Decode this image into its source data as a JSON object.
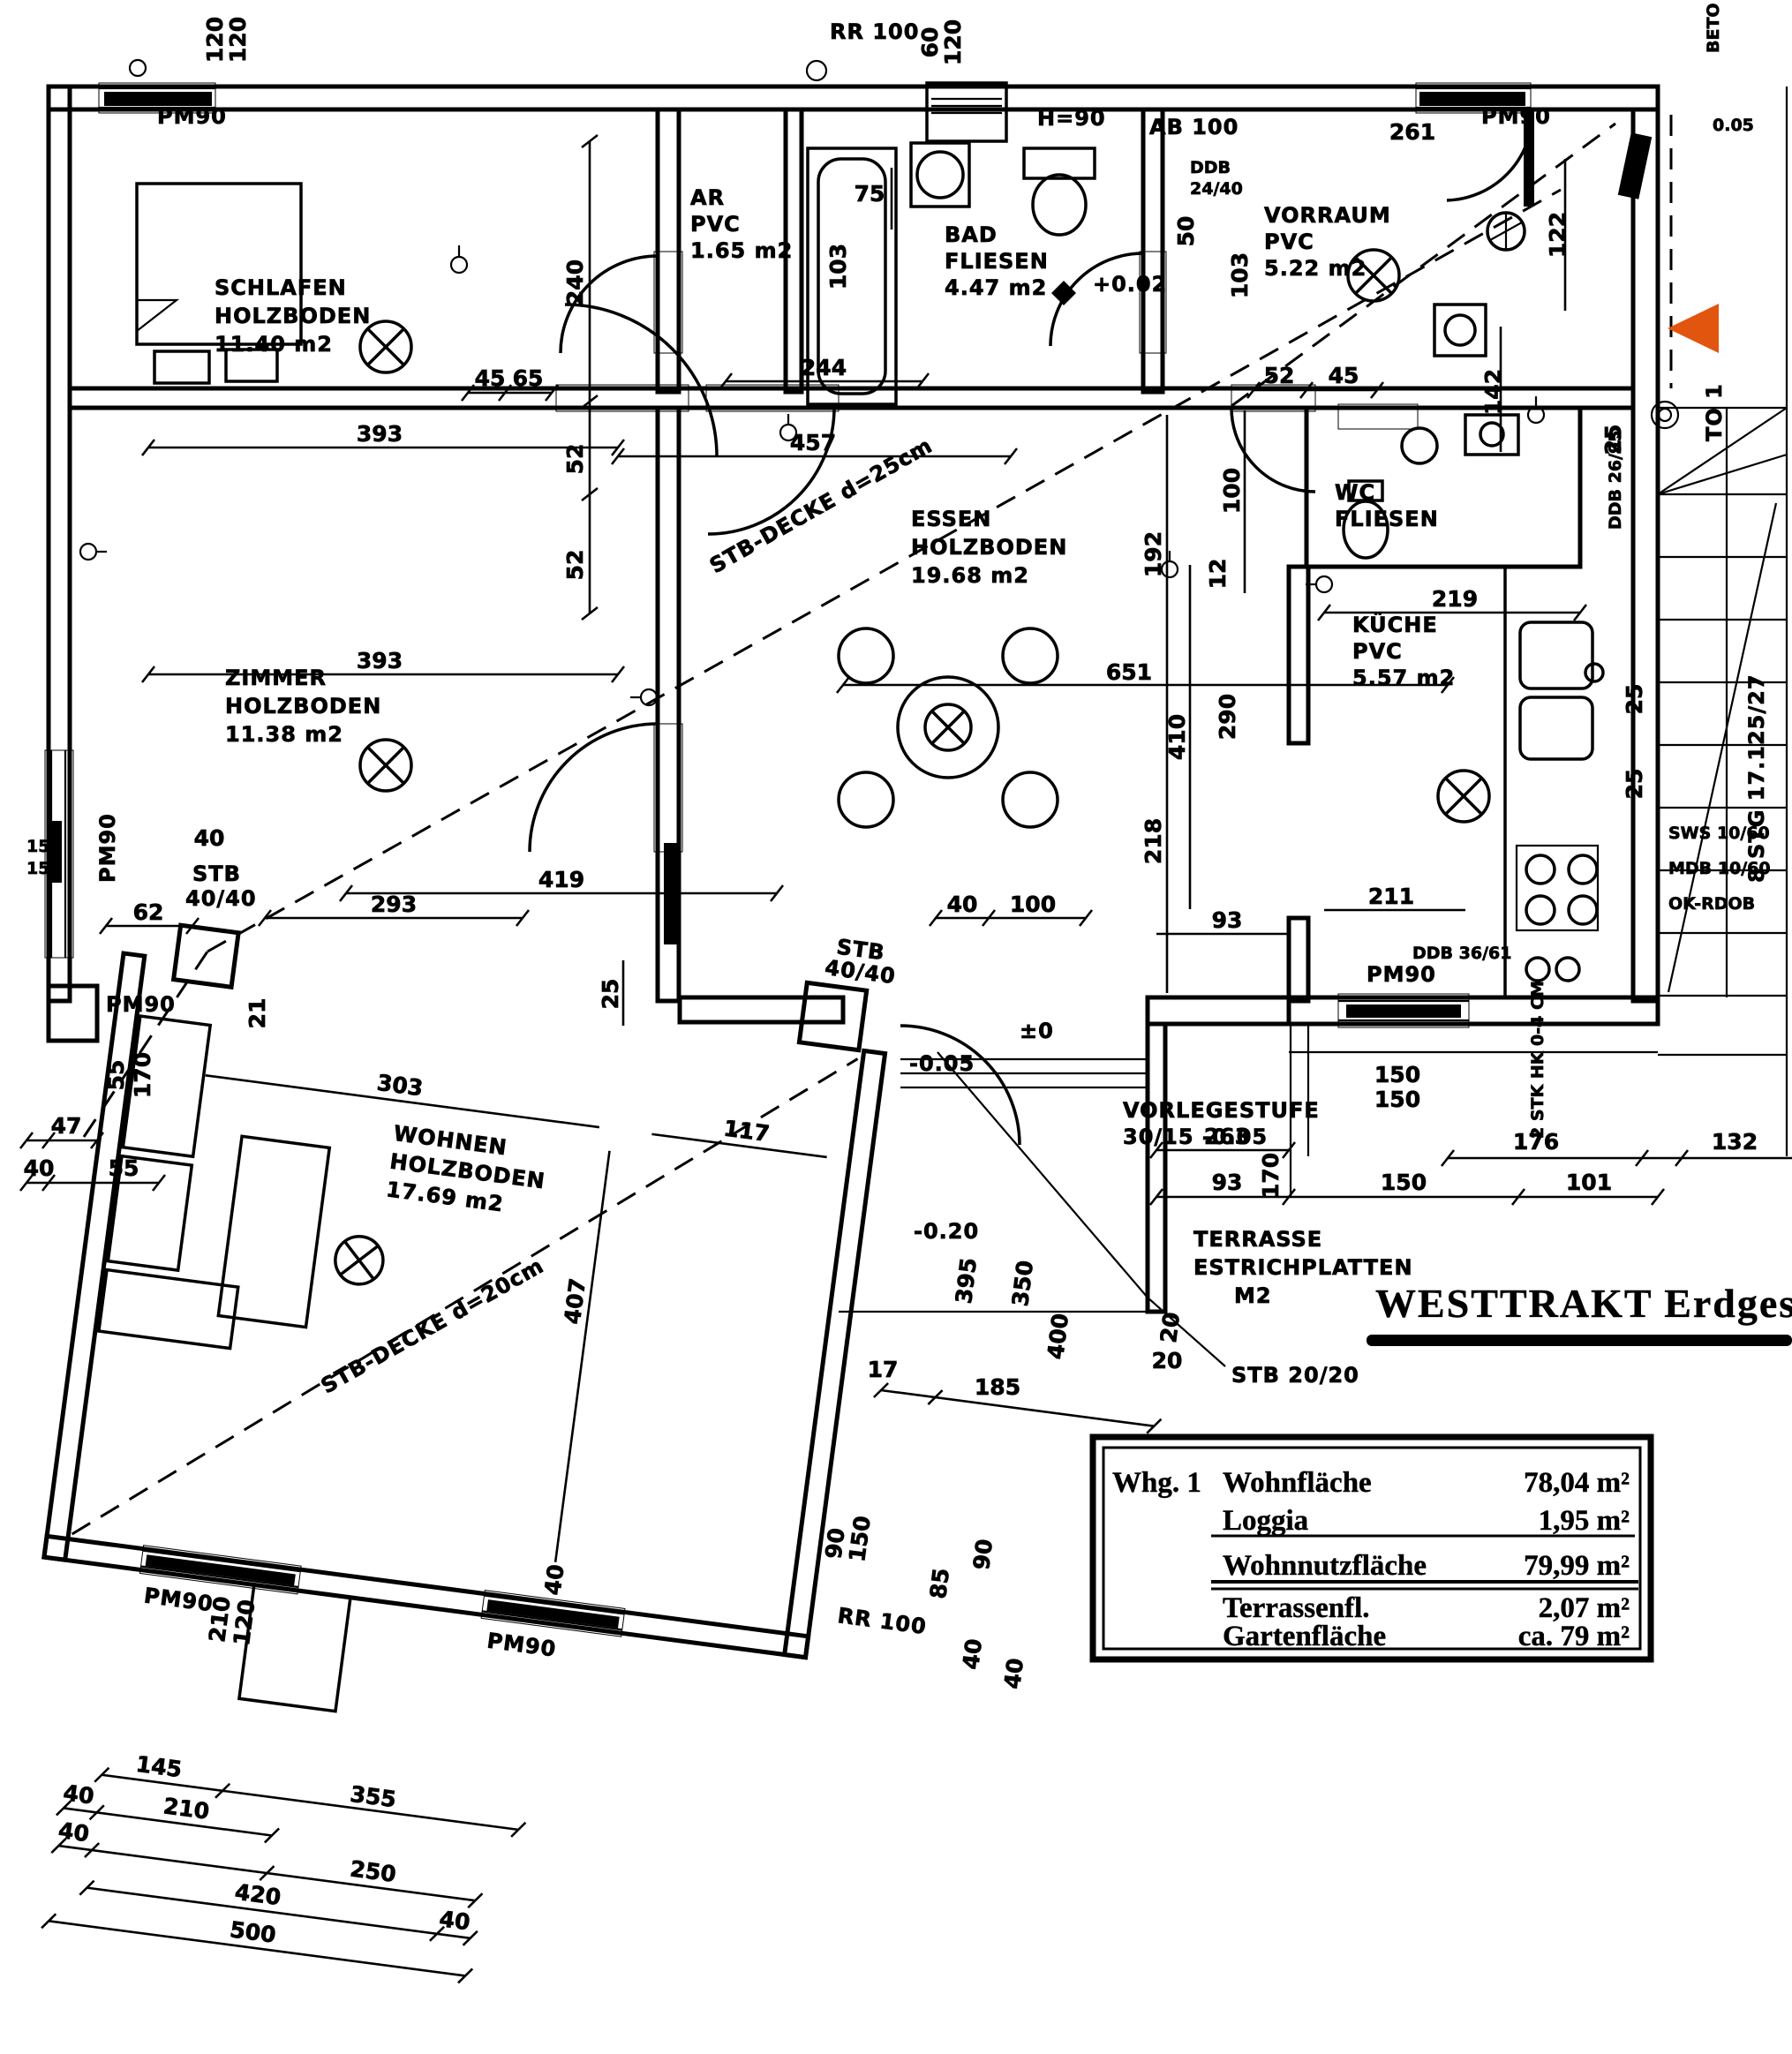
{
  "colors": {
    "ink": "#000000",
    "paper": "#ffffff",
    "arrow": "#e2550e"
  },
  "title": {
    "text": "WESTTRAKT  Erdgescho"
  },
  "table": {
    "unit": "Whg. 1",
    "rows": [
      {
        "label": "Wohnfläche",
        "value": "78,04 m²"
      },
      {
        "label": "Loggia",
        "value": "1,95 m²"
      },
      {
        "label": "Wohnnutzfläche",
        "value": "79,99 m²"
      },
      {
        "label": "Terrassenfl.",
        "value": "2,07 m²"
      },
      {
        "label": "Gartenfläche",
        "value": "ca. 79 m²"
      }
    ]
  },
  "rooms": {
    "schlafen": {
      "name": "SCHLAFEN",
      "floor": "HOLZBODEN",
      "area": "11.40 m2"
    },
    "zimmer": {
      "name": "ZIMMER",
      "floor": "HOLZBODEN",
      "area": "11.38 m2"
    },
    "essen": {
      "name": "ESSEN",
      "floor": "HOLZBODEN",
      "area": "19.68 m2"
    },
    "wohnen": {
      "name": "WOHNEN",
      "floor": "HOLZBODEN",
      "area": "17.69 m2"
    },
    "bad": {
      "name": "BAD",
      "floor": "FLIESEN",
      "area": "4.47 m2"
    },
    "ar": {
      "name": "AR",
      "floor": "PVC",
      "area": "1.65 m2"
    },
    "vorraum": {
      "name": "VORRAUM",
      "floor": "PVC",
      "area": "5.22 m2"
    },
    "kueche": {
      "name": "KÜCHE",
      "floor": "PVC",
      "area": "5.57 m2"
    },
    "wc": {
      "name": "WC",
      "floor": "FLIESEN"
    },
    "terrasse": {
      "name": "TERRASSE",
      "floor": "ESTRICHPLATTEN",
      "area": "M2"
    }
  },
  "notes": {
    "decke25": "STB-DECKE d=25cm",
    "decke20": "STB-DECKE d=20cm",
    "vorlegestufe1": "VORLEGESTUFE",
    "vorlegestufe2": "30/15  -0.05",
    "stb2020": "STB 20/20",
    "stb": "STB",
    "stb4040": "40/40",
    "pm90": "PM90",
    "rr100": "RR 100",
    "h90": "H=90",
    "ab100": "AB 100",
    "ddb1": "DDB",
    "ddb2": "24/40",
    "ddb2695": "DDB 26/95",
    "ddb3661": "DDB 36/61",
    "stg": "8 STG 17.125/27",
    "to1": "TO 1",
    "beto": "BETO",
    "p005": "0.05",
    "sws": "SWS 10/60",
    "mdb": "MDB 10/60",
    "ok": "OK-RDOB",
    "hk": "2 STK HK 0-4 CM",
    "lvl_bad": "+0.02",
    "lvl_m005": "-0.05",
    "lvl_m020": "-0.20",
    "lvl_0": "±0"
  },
  "dims": [
    "120",
    "120",
    "60",
    "120",
    "261",
    "122",
    "50",
    "103",
    "52",
    "45",
    "142",
    "75",
    "103",
    "244",
    "457",
    "240",
    "52",
    "52",
    "393",
    "45",
    "65",
    "393",
    "419",
    "293",
    "25",
    "150",
    "150",
    "62",
    "40",
    "21",
    "55",
    "170",
    "47",
    "40",
    "55",
    "192",
    "12",
    "100",
    "651",
    "410",
    "290",
    "218",
    "40",
    "100",
    "93",
    "211",
    "219",
    "25",
    "25",
    "25",
    "176",
    "132",
    "150",
    "101",
    "93",
    "170",
    "263",
    "150",
    "150",
    "395",
    "350",
    "400",
    "85",
    "90",
    "40",
    "40",
    "17",
    "185",
    "20",
    "303",
    "117",
    "407",
    "40",
    "90",
    "150",
    "210",
    "120",
    "145",
    "355",
    "40",
    "210",
    "40",
    "250",
    "420",
    "40",
    "500",
    "20"
  ]
}
